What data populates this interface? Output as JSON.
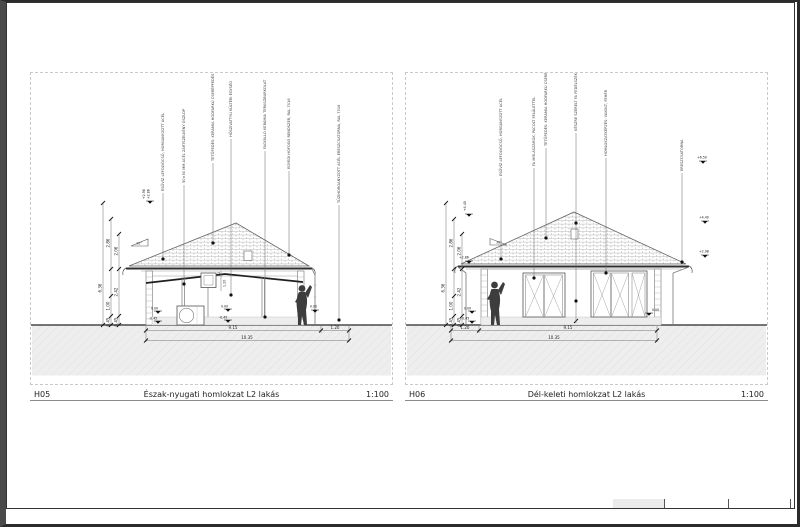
{
  "sheet": {
    "frame_color": "#2e2e2e",
    "background": "#ffffff"
  },
  "panels": [
    {
      "code": "H05",
      "title": "Észak-nyugati homlokzat L2 lakás",
      "scale": "1:100"
    },
    {
      "code": "H06",
      "title": "Dél-keleti homlokzat L2 lakás",
      "scale": "1:100"
    }
  ],
  "left": {
    "slope": "30°",
    "window_mark": "K2",
    "window_dim": "1.20",
    "callouts": [
      "ESŐVÍZ LEFOLYÓCSŐ, HORGANYZOTT ACÉL",
      "50×50 MM ACÉL ZÁRTSZELVÉNY OSZLOP",
      "TETŐFEDÉS: KERÁMIA HÓDFARKÚ CSERÉPFEDÉS",
      "HŐSZIVATTYÚ KÜLTÉRI EGYSÉG",
      "FAGYÁLLÓ KERÁMIA TERASZBURKOLAT",
      "EGYEDI HÓFOGÓ RENDSZER, RAL 7016",
      "TŰZIHORGANYZOTT ACÉL ERESZCSATORNA, RAL 7016"
    ],
    "vdims": {
      "total": "6.36",
      "a": "2.86",
      "b": "2.06",
      "c": "2.42",
      "d": "1.00",
      "e": "0.45",
      "f": "0.45"
    },
    "hdims": {
      "main": "9.15",
      "side": "1.20",
      "total": "10.35"
    },
    "levels": {
      "zero": "0.00",
      "minus": "-0.45",
      "eave": "+2.86",
      "attic": "+2.98"
    }
  },
  "right": {
    "slope": "30°",
    "callouts": [
      "ESŐVÍZ LEFOLYÓCSŐ, HORGANYZOTT ACÉL",
      "FA NYÍLÁSZÁRÓK, PÁCOLT FELÜLETTEL",
      "TETŐFEDÉS: KERÁMIA HÓDFARKÚ CSERÉPFEDÉS",
      "KÉSZRE SZERELT FA FEDÉLSZÉK",
      "HOMLOKZATKÉPZÉS: VAKOLT, FEHÉR",
      "ERESZCSATORNA"
    ],
    "vdims": {
      "total": "6.36",
      "a": "2.86",
      "b": "2.06",
      "c": "2.42",
      "d": "1.00",
      "e": "0.45",
      "f": "0.45"
    },
    "hdims": {
      "main": "9.15",
      "side": "1.20",
      "total": "10.35"
    },
    "levels": {
      "zero": "0.00",
      "minus": "-0.45",
      "eave": "+2.86",
      "mid": "+4.40",
      "upper": "+2.98",
      "top": "+6.50"
    }
  }
}
